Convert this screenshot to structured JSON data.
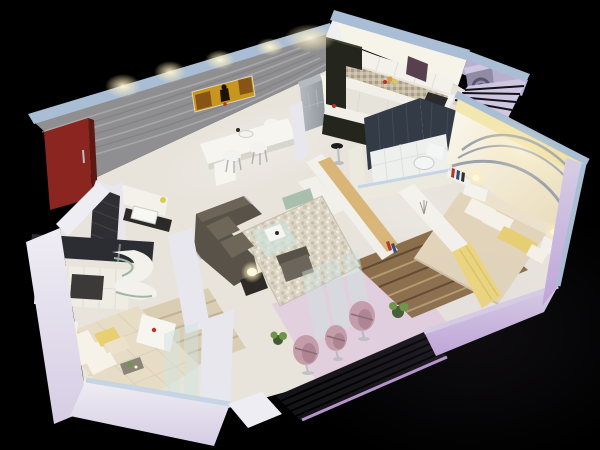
{
  "scene": {
    "type": "3d-isometric-floor-plan-render",
    "background": "#000000",
    "rooms": [
      "foyer-entrance",
      "dining-area",
      "kitchen",
      "utility-balcony",
      "bathroom",
      "bedroom-2",
      "living-room",
      "master-bedroom",
      "master-bathroom",
      "balcony-sitout"
    ],
    "furniture": [
      "entry-door",
      "wall-artwork",
      "dining-table",
      "dining-chairs",
      "wash-basin",
      "refrigerator",
      "kitchen-cabinets",
      "breakfast-bar",
      "bar-stool",
      "washing-machine",
      "toilet",
      "double-bed-2",
      "striped-rug",
      "nightstand-lamps",
      "book-rack",
      "study-desk",
      "tv-partition-unit",
      "sectional-sofa",
      "armchair",
      "glass-coffee-table",
      "pebble-rug",
      "floor-lamp",
      "balcony-egg-chairs",
      "plants",
      "master-bed",
      "wardrobe",
      "curved-dresser",
      "bench-ottoman",
      "glass-partition",
      "louver-railing"
    ]
  },
  "colors": {
    "background": "#000000",
    "wallTopBand": "#a9bdd5",
    "wallTopBandLight": "#c6d4e4",
    "outerWallLight": "#efedf4",
    "outerWallLavender": "#d6cde4",
    "outerWallPurple": "#bfa6d8",
    "wavyWall": "#8f8f91",
    "wavyWallStreak": "#bcbcbe",
    "wavyWallStreakDark": "#737376",
    "entryDoor": "#8a2520",
    "entryDoorDark": "#5f1714",
    "artGold": "#c8961e",
    "artBrown": "#7a4a14",
    "artFigure": "#1c1208",
    "artRed": "#c03020",
    "floorMain": "#e8e4dc",
    "floorKitchen": "#f4f2ea",
    "floorBath": "#eef0ee",
    "bathFloorLine": "#d8ded8",
    "floorBalcony": "#e2cfdd",
    "kitchenWallLit": "#f6f3e9",
    "kitchenWallSide": "#eef0f2",
    "cabinetWhite": "#f3f1ea",
    "cabinetShadow": "#d8d5cc",
    "backsplash": "#c3b8a2",
    "hoodMaroon": "#58414e",
    "counterFace": "#e6e3da",
    "cooktop": "#2a2a2c",
    "darkCabinet": "#24261d",
    "darkCabinetHi": "#3b3e30",
    "barTop": "#f1efe8",
    "stool": "#1c1c1e",
    "chrome": "#b9bcc0",
    "fridgeBody": "#b4bac0",
    "fridgeDark": "#8e959c",
    "utilityWall": "#b9b0d0",
    "utilityWallLight": "#cfc7e2",
    "washerBody": "#928ba6",
    "washerDoor": "#5a5470",
    "louverDark": "#141317",
    "louverGlow": "#c9a4e0",
    "bathWallDark": "#333b47",
    "bathWallLine": "#46505e",
    "toiletWhite": "#f4f6f6",
    "partitionWhite": "#eceadf",
    "bed2Duvet": "#e2d5ba",
    "bed2Head": "#ece2cc",
    "pillowWhite": "#f6f2e8",
    "pillowYellow": "#e7cf72",
    "throwYellow": "#ecd67c",
    "throwFold": "#d4b858",
    "rug2Base": "#8a6d48",
    "rug2Stripe": "#5e472c",
    "rug2StripeLight": "#b49a6e",
    "nightstand": "#f4f2ec",
    "lampGlow": "#ffeebb",
    "lampCore": "#fff8e0",
    "swooshGray": "#9aa2ac",
    "wallGlowYellow": "#eee08c",
    "tvUnitWhite": "#f2f0ea",
    "tvUnitWood": "#d9b678",
    "tvUnitSage": "#a8bfae",
    "bookRed": "#b03828",
    "bookBlue": "#2e4e7e",
    "bookDark": "#33302a",
    "pebbleDot": "#c6bead",
    "sofaDark": "#585249",
    "sofaCushion": "#6e6659",
    "glassTable": "#cfe0da",
    "glassEdge": "#e9f4ef",
    "sideTableDark": "#2e2a26",
    "armchair": "#6b655c",
    "diningTable": "#f6f5f0",
    "chairWhite": "#f2f2ee",
    "chairLeg": "#b0b0b2",
    "basinCounter": "#2c2a28",
    "basinWhite": "#f7f7f4",
    "soapYellow": "#d8cc50",
    "fruit": "#e09a2e",
    "foyerTile": "#2f2f33",
    "foyerTileLine": "#46464c",
    "masterBathBand": "#2b2d33",
    "wardrobeFrame": "#efece4",
    "wardrobeClothesDark": "#3c3a38",
    "wardrobeYellow": "#e8e05a",
    "deskCurve": "#f2f1ec",
    "deskSage": "#9fb5a8",
    "bed1Duvet": "#e7dcc6",
    "bed1Quilt": "#d9ccb2",
    "benchWhite": "#f6f5f0",
    "rug1Base": "#d9cdb4",
    "rug1Stripe": "#c2b394",
    "trayDark": "#8a8578",
    "plantGreen": "#6e9446",
    "plantDark": "#3f5c30",
    "glassPane": "#cfe4e0",
    "balconyChair": "#c59ca8",
    "balconyChairDark": "#a87e8c",
    "balconyChairSlit": "#8a6a76",
    "innerWallWhite": "#e9e7ee",
    "bedWallLight": "#fbf8ef",
    "bedWallWarm": "#e8d9b4"
  }
}
